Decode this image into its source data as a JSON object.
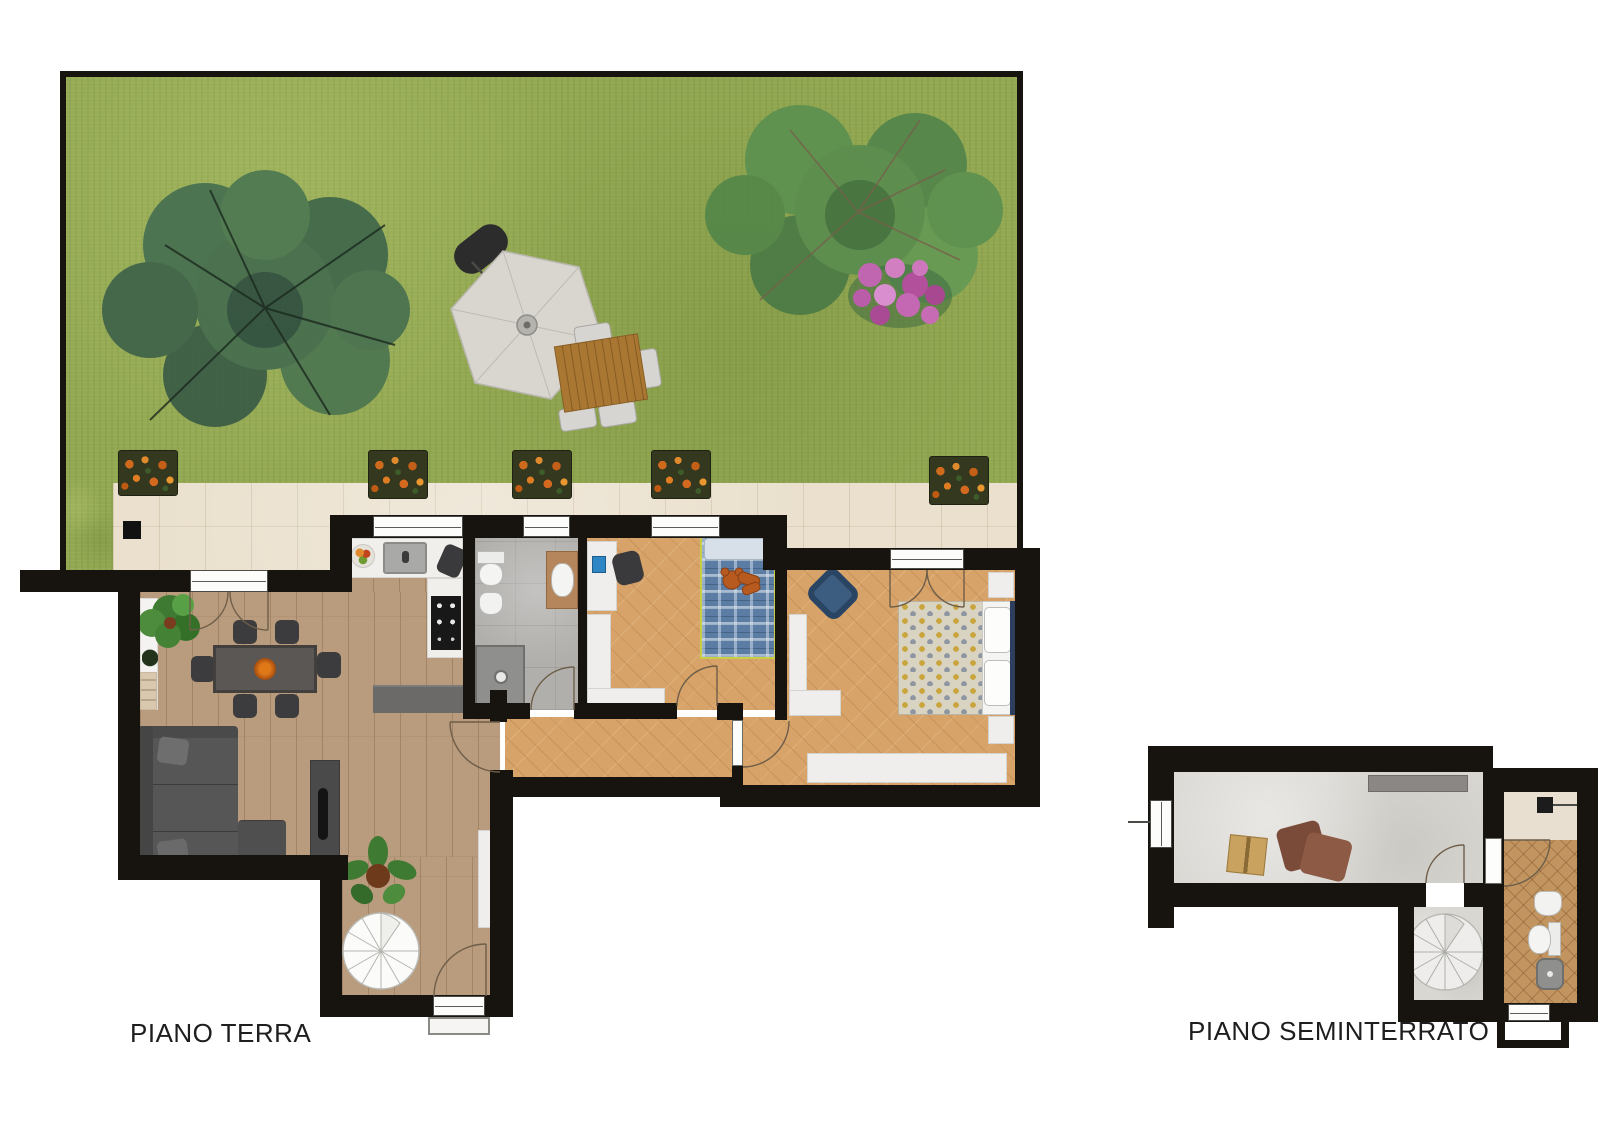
{
  "meta": {
    "type": "real-estate-floor-plan",
    "language": "it"
  },
  "labels": {
    "ground_floor": "PIANO TERRA",
    "basement": "PIANO SEMINTERRATO"
  },
  "floors": [
    {
      "id": "piano-terra",
      "label": "PIANO TERRA",
      "areas": [
        "garden",
        "terrace",
        "living-dining-room",
        "kitchen",
        "bathroom",
        "single-bedroom",
        "double-bedroom",
        "hallway",
        "spiral-stair-room"
      ]
    },
    {
      "id": "piano-seminterrato",
      "label": "PIANO SEMINTERRATO",
      "areas": [
        "taverna",
        "spiral-stair-room",
        "bathroom-laundry"
      ]
    }
  ],
  "colors": {
    "wall": "#17130e",
    "grass": "#92a851",
    "patio": "#eae0cd",
    "wood": "#b99b7d",
    "parquet": "#d7a369",
    "bath_tile": "#b1afac",
    "kitchen": "#edecea",
    "concrete": "#d9d7d2",
    "basement_tile": "#c29560",
    "sofa": "#565656",
    "flower_orange": "#d2691e",
    "flower_pink": "#c468b4",
    "tree_green": "#4a7251",
    "umbrella_gray": "#d8d6cf"
  }
}
